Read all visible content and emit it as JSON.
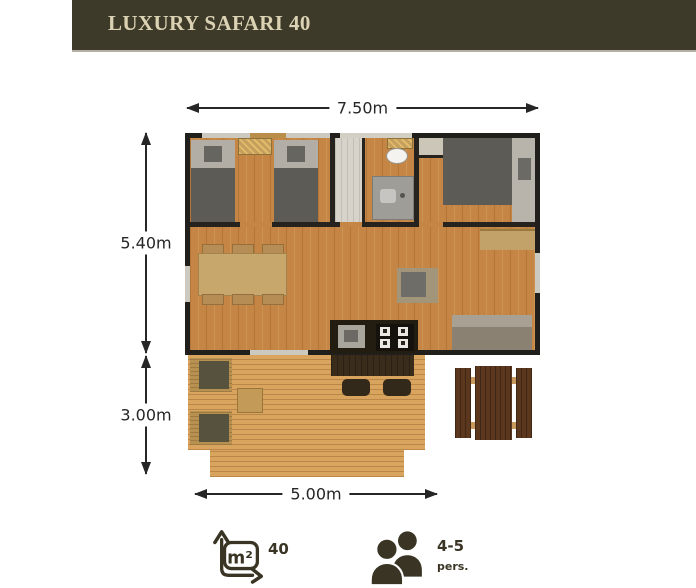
{
  "header": {
    "title": "LUXURY SAFARI 40"
  },
  "plan": {
    "dim_top": "7.50m",
    "dim_left_upper": "5.40m",
    "dim_left_lower": "3.00m",
    "dim_bottom": "5.00m"
  },
  "legend": {
    "area_unit": "m²",
    "area_value": "40",
    "capacity_value": "4-5",
    "capacity_unit": "pers."
  },
  "colors": {
    "header_bg": "#3e3a29",
    "header_text": "#dbd2b4",
    "icon": "#393423",
    "dimension_text": "#262626",
    "wall": "#211f1b",
    "floor_wood": "#c58544",
    "deck_wood": "#d8a45e",
    "picnic_wood": "#5b371d"
  }
}
